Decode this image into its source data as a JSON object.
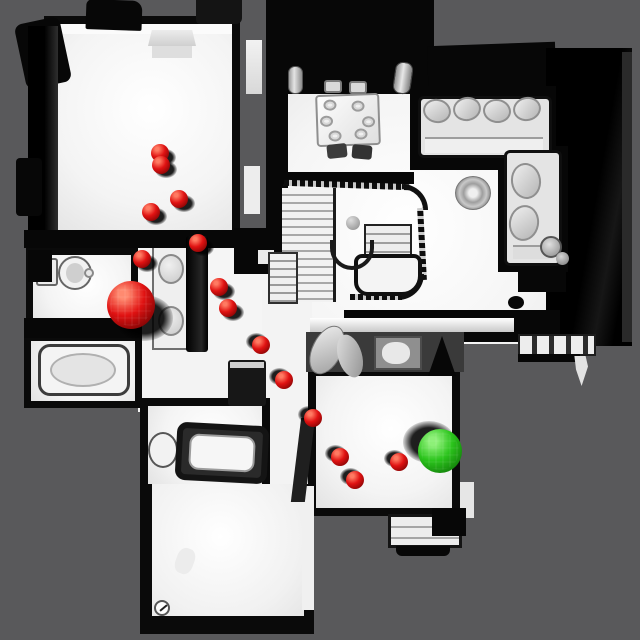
{
  "palette": {
    "background": "#59595b",
    "floor": "#f5f5f5",
    "wall": "#0a0a0a",
    "waypoint": {
      "color": "#e01212",
      "highlight": "#ff7a62",
      "shade": "#6b0000"
    },
    "start": {
      "color": "#e01212",
      "highlight": "#ff8a70",
      "shade": "#5f0000"
    },
    "goal": {
      "color": "#2bc41c",
      "highlight": "#8df078",
      "shade": "#0a6a04"
    }
  },
  "markers": {
    "start": {
      "x": 131,
      "y": 305,
      "r": 24,
      "sd": "dr"
    },
    "goal": {
      "x": 440,
      "y": 451,
      "r": 22,
      "sd": "ul"
    },
    "waypoints": [
      {
        "x": 160,
        "y": 153,
        "r": 9,
        "sd": "dr"
      },
      {
        "x": 161,
        "y": 165,
        "r": 9,
        "sd": "dr"
      },
      {
        "x": 179,
        "y": 199,
        "r": 9,
        "sd": "dr"
      },
      {
        "x": 151,
        "y": 212,
        "r": 9,
        "sd": "dr"
      },
      {
        "x": 198,
        "y": 243,
        "r": 9,
        "sd": "dr"
      },
      {
        "x": 142,
        "y": 259,
        "r": 9,
        "sd": "dr"
      },
      {
        "x": 219,
        "y": 287,
        "r": 9,
        "sd": "dr"
      },
      {
        "x": 228,
        "y": 308,
        "r": 9,
        "sd": "dr"
      },
      {
        "x": 261,
        "y": 345,
        "r": 9,
        "sd": "ul"
      },
      {
        "x": 284,
        "y": 380,
        "r": 9,
        "sd": "ul"
      },
      {
        "x": 313,
        "y": 418,
        "r": 9,
        "sd": "ul"
      },
      {
        "x": 340,
        "y": 457,
        "r": 9,
        "sd": "ul"
      },
      {
        "x": 355,
        "y": 480,
        "r": 9,
        "sd": "ul"
      },
      {
        "x": 399,
        "y": 462,
        "r": 9,
        "sd": "ul"
      }
    ]
  }
}
